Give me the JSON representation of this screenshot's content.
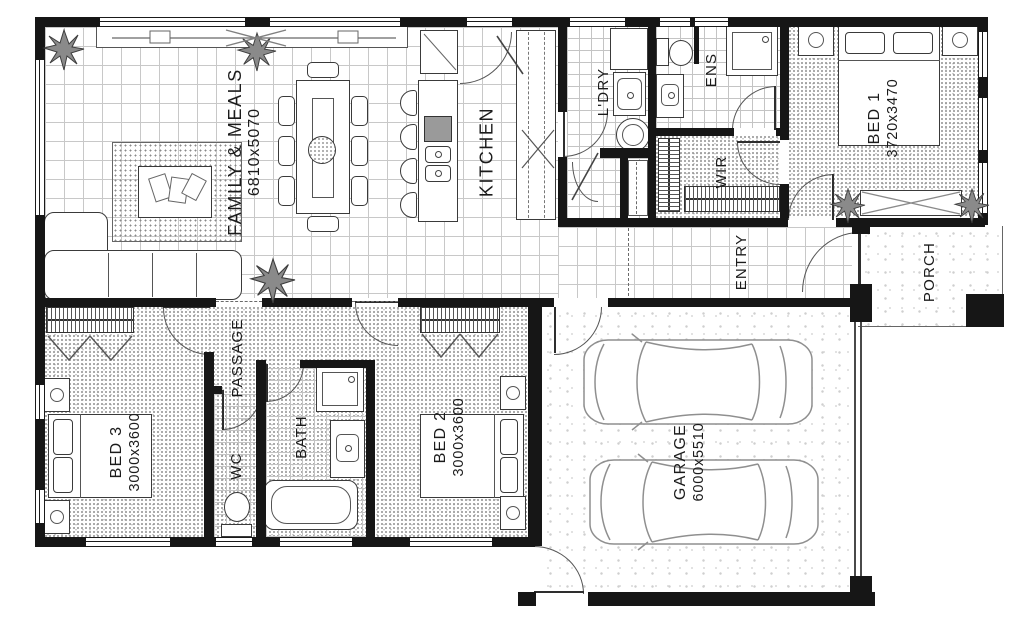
{
  "plan": {
    "rooms": {
      "family": {
        "name": "FAMILY & MEALS",
        "dims": "6810x5070"
      },
      "kitchen": {
        "name": "KITCHEN"
      },
      "laundry": {
        "name": "L'DRY"
      },
      "ensuite": {
        "name": "ENS"
      },
      "wir": {
        "name": "WIR"
      },
      "bed1": {
        "name": "BED 1",
        "dims": "3720x3470"
      },
      "entry": {
        "name": "ENTRY"
      },
      "porch": {
        "name": "PORCH"
      },
      "passage": {
        "name": "PASSAGE"
      },
      "bed3": {
        "name": "BED 3",
        "dims": "3000x3600"
      },
      "wc": {
        "name": "WC"
      },
      "bath": {
        "name": "BATH"
      },
      "bed2": {
        "name": "BED 2",
        "dims": "3000x3600"
      },
      "garage": {
        "name": "GARAGE",
        "dims": "6000x5510"
      }
    },
    "colors": {
      "wall": "#161616",
      "line": "#555555",
      "tile_line": "#c8c8c8",
      "fixture_gray": "#9a9a9a"
    }
  }
}
